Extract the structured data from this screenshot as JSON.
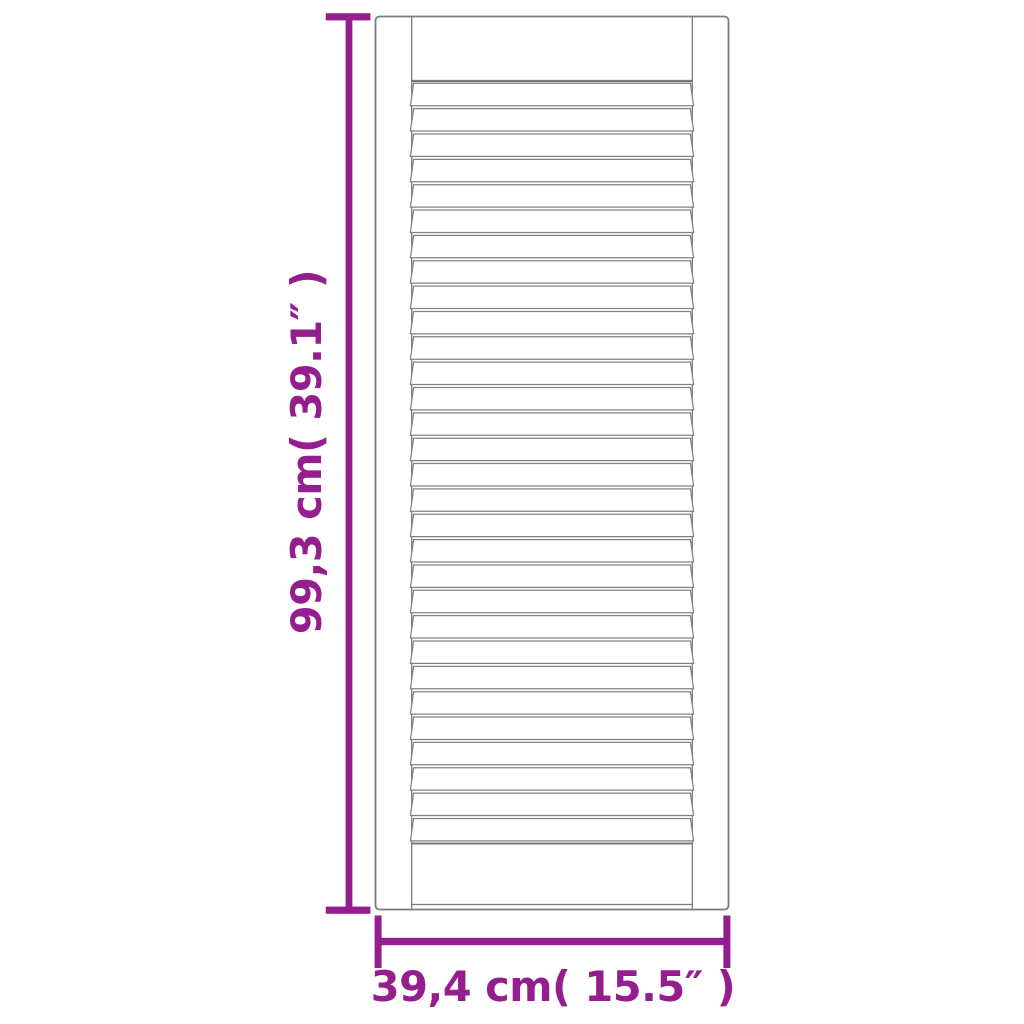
{
  "image": {
    "kind": "product-dimension-diagram",
    "subject": "louvre-slatted-cabinet-door",
    "background_color": "#ffffff"
  },
  "drawing": {
    "louver_count": 30,
    "colors": {
      "door_outline": "#7b7b7b",
      "dimension_accent": "#951E8F"
    }
  },
  "dimensions": {
    "height_label": "99,3 cm( 39.1″ )",
    "width_label": "39,4 cm( 15.5″ )"
  }
}
